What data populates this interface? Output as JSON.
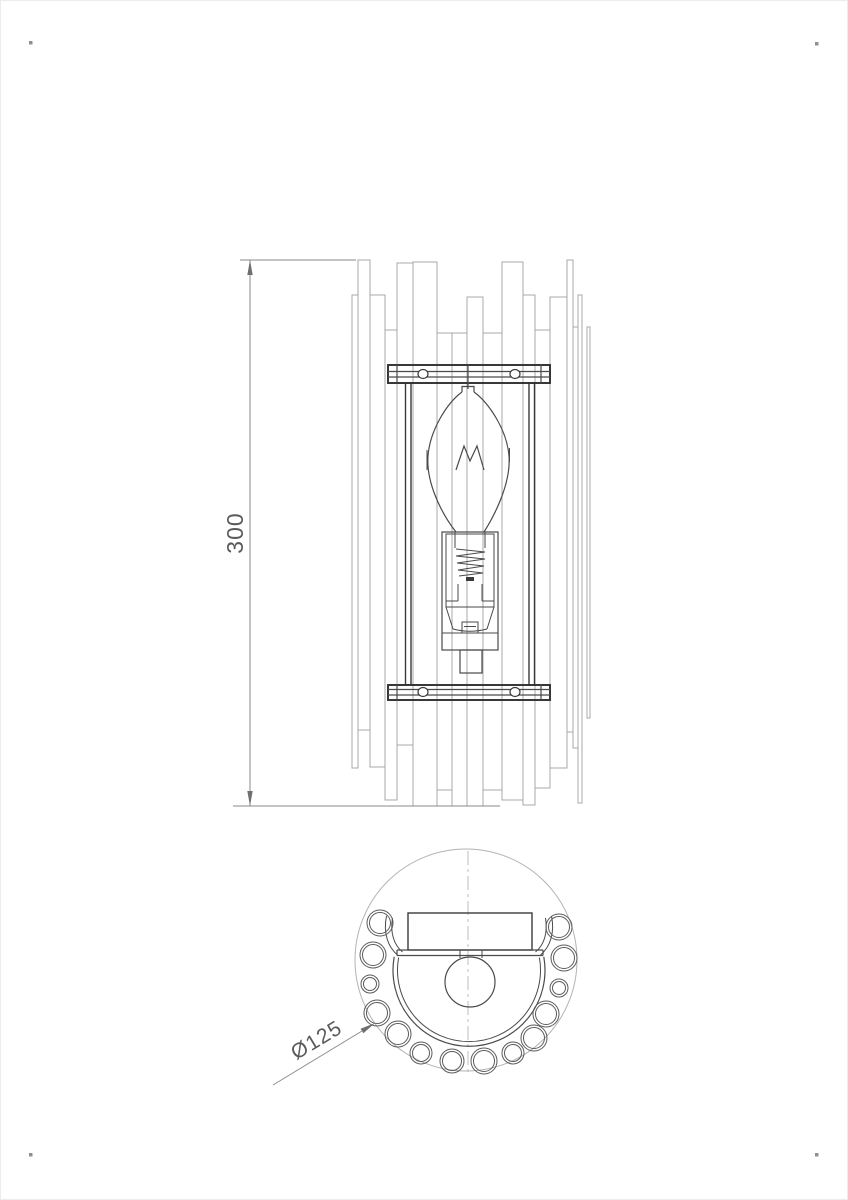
{
  "drawing": {
    "front_view": {
      "height_dimension_label": "300",
      "slats": [
        {
          "x": 352,
          "w": 6,
          "top": 295,
          "bot": 768
        },
        {
          "x": 358,
          "w": 12,
          "top": 260,
          "bot": 730
        },
        {
          "x": 370,
          "w": 15,
          "top": 295,
          "bot": 767
        },
        {
          "x": 385,
          "w": 12,
          "top": 330,
          "bot": 800
        },
        {
          "x": 397,
          "w": 16,
          "top": 263,
          "bot": 745
        },
        {
          "x": 413,
          "w": 24,
          "top": 262,
          "bot": 806
        },
        {
          "x": 437,
          "w": 15,
          "top": 333,
          "bot": 790
        },
        {
          "x": 452,
          "w": 15,
          "top": 333,
          "bot": 806
        },
        {
          "x": 467,
          "w": 16,
          "top": 297,
          "bot": 806
        },
        {
          "x": 483,
          "w": 19,
          "top": 333,
          "bot": 790
        },
        {
          "x": 502,
          "w": 21,
          "top": 262,
          "bot": 800
        },
        {
          "x": 523,
          "w": 12,
          "top": 295,
          "bot": 805
        },
        {
          "x": 535,
          "w": 15,
          "top": 330,
          "bot": 788
        },
        {
          "x": 550,
          "w": 17,
          "top": 297,
          "bot": 768
        },
        {
          "x": 567,
          "w": 6,
          "top": 260,
          "bot": 732
        },
        {
          "x": 573,
          "w": 5,
          "top": 327,
          "bot": 748
        },
        {
          "x": 578,
          "w": 4,
          "top": 295,
          "bot": 803
        },
        {
          "x": 587,
          "w": 3,
          "top": 327,
          "bot": 718
        }
      ],
      "bracket_screw_holes": [
        [
          423,
          374
        ],
        [
          515,
          374
        ],
        [
          423,
          692
        ],
        [
          515,
          692
        ]
      ]
    },
    "top_view": {
      "diameter_dimension_label": "Ø125",
      "rod_sections": [
        {
          "x": 380,
          "y": 923,
          "r": 13
        },
        {
          "x": 373,
          "y": 955,
          "r": 13
        },
        {
          "x": 370,
          "y": 984,
          "r": 9
        },
        {
          "x": 377,
          "y": 1013,
          "r": 13
        },
        {
          "x": 398,
          "y": 1034,
          "r": 13
        },
        {
          "x": 421,
          "y": 1053,
          "r": 11
        },
        {
          "x": 452,
          "y": 1061,
          "r": 12
        },
        {
          "x": 484,
          "y": 1061,
          "r": 13
        },
        {
          "x": 513,
          "y": 1053,
          "r": 11
        },
        {
          "x": 534,
          "y": 1038,
          "r": 13
        },
        {
          "x": 546,
          "y": 1014,
          "r": 13
        },
        {
          "x": 559,
          "y": 988,
          "r": 9
        },
        {
          "x": 564,
          "y": 958,
          "r": 13
        },
        {
          "x": 559,
          "y": 927,
          "r": 13
        }
      ]
    },
    "corner_marks": [
      [
        29,
        41
      ],
      [
        815,
        42
      ],
      [
        29,
        1153
      ],
      [
        815,
        1153
      ]
    ],
    "colors": {
      "slat_line": "#a8a8a8",
      "detail_line": "#4a4a4a",
      "bracket_line": "#2e2e2e",
      "dimension_line": "#8a8a8a",
      "dimension_text": "#5a5a5a",
      "rod_line": "#5a5a5a",
      "light_line": "#b3b3b3"
    }
  }
}
